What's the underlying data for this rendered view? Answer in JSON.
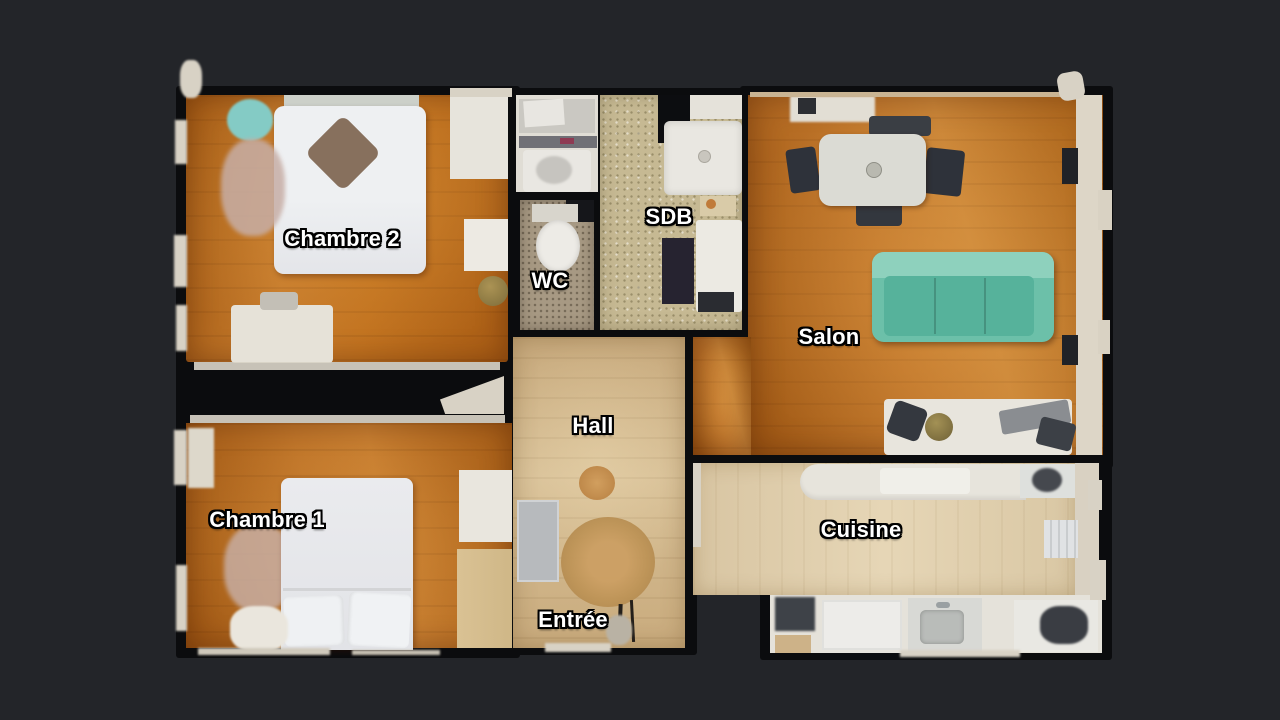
{
  "view": {
    "type": "apartment-floorplan-top-view"
  },
  "theme": {
    "background": "#232529",
    "wall": "#0b0c0e",
    "wall_edge": "#d8d2c5",
    "label_text": "#ffffff",
    "label_outline": "#000000",
    "bedroom_wood_floor": "#bd742a",
    "salon_wood_floor": "#bf752a",
    "hall_floor": "#cfb489",
    "kitchen_floor": "#decbaa",
    "bathroom_tile": "#c6b993",
    "wc_tile": "#a79983",
    "sofa_teal": "#6cc0a9",
    "beanbag_teal": "#84cbc5",
    "bed_white": "#e9e9ec",
    "rug_round_tan": "#c49a5e"
  },
  "floorplan": {
    "rooms": [
      {
        "id": "chambre2",
        "label": "Chambre 2"
      },
      {
        "id": "wc",
        "label": "WC"
      },
      {
        "id": "sdb",
        "label": "SDB"
      },
      {
        "id": "salon",
        "label": "Salon"
      },
      {
        "id": "hall",
        "label": "Hall"
      },
      {
        "id": "chambre1",
        "label": "Chambre 1"
      },
      {
        "id": "cuisine",
        "label": "Cuisine"
      },
      {
        "id": "entree",
        "label": "Entrée"
      }
    ]
  }
}
